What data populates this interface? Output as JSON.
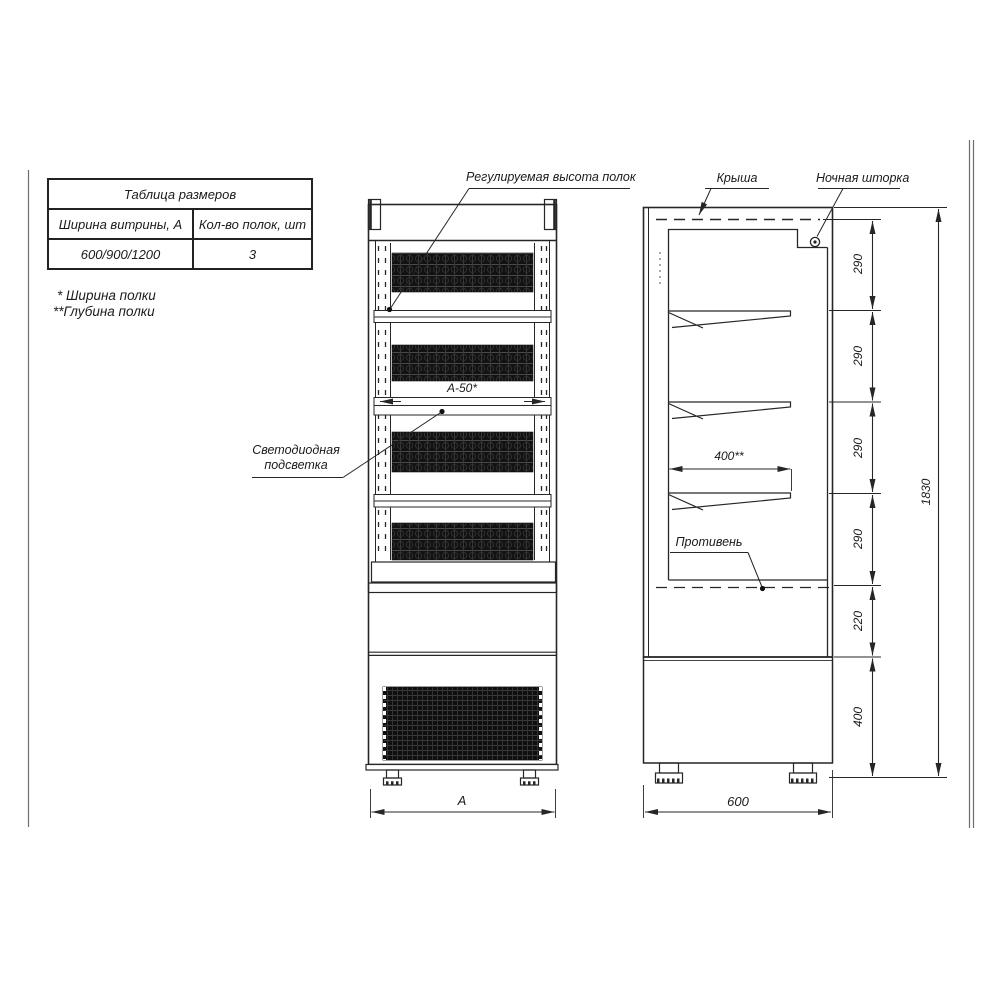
{
  "page": {
    "background": "#ffffff",
    "line_color": "#262626"
  },
  "size_table": {
    "title": "Таблица размеров",
    "columns": [
      "Ширина витрины, А",
      "Кол-во полок, шт"
    ],
    "rows": [
      [
        "600/900/1200",
        "3"
      ]
    ]
  },
  "footnotes": {
    "width_note": "* Ширина полки",
    "depth_note": "**Глубина полки"
  },
  "callouts": {
    "shelf_height": "Регулируемая высота полок",
    "roof": "Крыша",
    "night_curtain": "Ночная шторка",
    "led_line1": "Светодиодная",
    "led_line2": "подсветка",
    "tray": "Противень"
  },
  "dimensions": {
    "front_width": "А",
    "shelf_width": "А-50*",
    "shelf_depth": "400**",
    "cabinet_depth": "600",
    "total_height": "1830",
    "base_height": "400",
    "tray_zone": "220",
    "spacing_top": "290",
    "spacing_2": "290",
    "spacing_3": "290",
    "spacing_4": "290"
  }
}
